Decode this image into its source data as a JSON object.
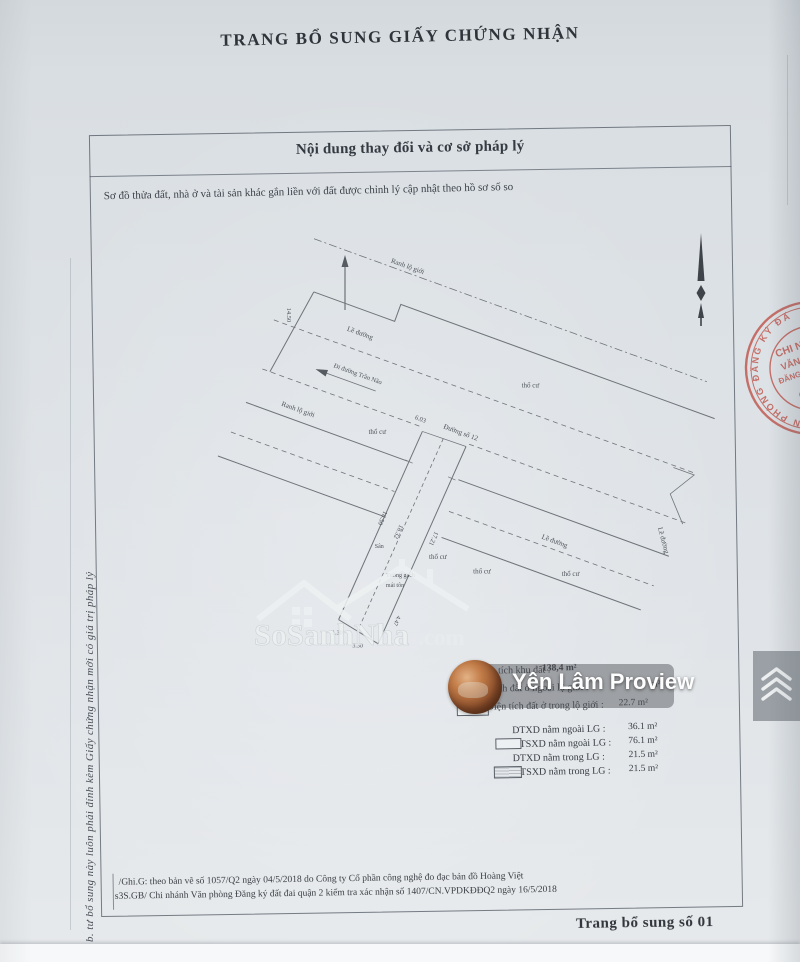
{
  "page": {
    "title": "TRANG BỔ SUNG GIẤY CHỨNG NHẬN",
    "side_note": "b. tư bổ sung này luôn phải đính kèm Giấy chứng nhận mới có giá trị pháp lý",
    "page_footer": "Trang bổ sung số 01"
  },
  "content_box": {
    "header": "Nội dung thay đổi và cơ sở pháp lý",
    "subtitle": "Sơ đồ thửa đất, nhà ở và tài sản khác gắn liền với đất được chỉnh lý cập nhật theo hồ sơ số so",
    "footnote_line1": "/Ghi.G: theo bản vẽ số 1057/Q2 ngày 04/5/2018 do Công ty Cổ phần công nghệ đo đạc bản đồ Hoàng Việt",
    "footnote_line2": "s3S.GB/ Chi nhánh Văn phòng Đăng ký đất đai quận 2 kiểm tra xác nhận số 1407/CN.VPDKĐĐQ2 ngày 16/5/2018"
  },
  "map": {
    "labels": {
      "ranh_lo_gioi_top": "Ranh lộ giới",
      "ranh_lo_gioi_left": "Ranh lộ giới",
      "le_duong_1": "Lề đường",
      "le_duong_2": "Lề đường",
      "le_duong_3": "Lề đường",
      "di_duong_tran_nao": "Đi đường Trần Não",
      "duong_so_12": "Đường số 12",
      "tho_cu_1": "thổ cư",
      "tho_cu_2": "thổ cư",
      "tho_cu_3": "thổ cư",
      "tho_cu_4": "thổ cư",
      "tho_cu_5": "thổ cư",
      "tuong_gach_line1": "Tường gạch",
      "tuong_gach_line2": "mái tôn",
      "san": "Sân"
    },
    "dimensions": {
      "d1": "14.50",
      "d2": "6.03",
      "d3": "18.50",
      "d4": "18.32",
      "d5": "17.21",
      "d6": "4.47",
      "d7": "1.30",
      "d8": "3.30"
    }
  },
  "legend": {
    "area_rows": [
      {
        "label": "Diện tích khu đất :",
        "value": "138,4 m²"
      },
      {
        "label": "Diện tích đất ở ngoài lộ giới :",
        "value": "m²"
      },
      {
        "label": "Diện tích đất ở trong lộ giới :",
        "value": "22.7 m²"
      }
    ],
    "build_rows": [
      {
        "label": "DTXD nằm ngoài LG :",
        "value": "36.1 m²"
      },
      {
        "label": "DTSXD nằm ngoài LG :",
        "value": "76.1 m²"
      },
      {
        "label": "DTXD nằm trong LG :",
        "value": "21.5 m²"
      },
      {
        "label": "DTSXD nằm trong LG :",
        "value": "21.5 m²"
      }
    ]
  },
  "stamp": {
    "ring_text": "VĂN PHÒNG ĐĂNG KÝ ĐẤT ĐAI",
    "line1": "CHI NHÁNH",
    "line2": "VĂN PHÒNG",
    "line3": "ĐĂNG KÝ ĐẤT ĐAI",
    "line4": "QUẬN 2",
    "color": "#bf4f46"
  },
  "watermarks": {
    "sosanhnha": {
      "name": "SoSanhNha",
      "tld": ".com",
      "tagline": "Great choice for you"
    },
    "proview": {
      "label": "Yên Lâm Proview"
    }
  }
}
